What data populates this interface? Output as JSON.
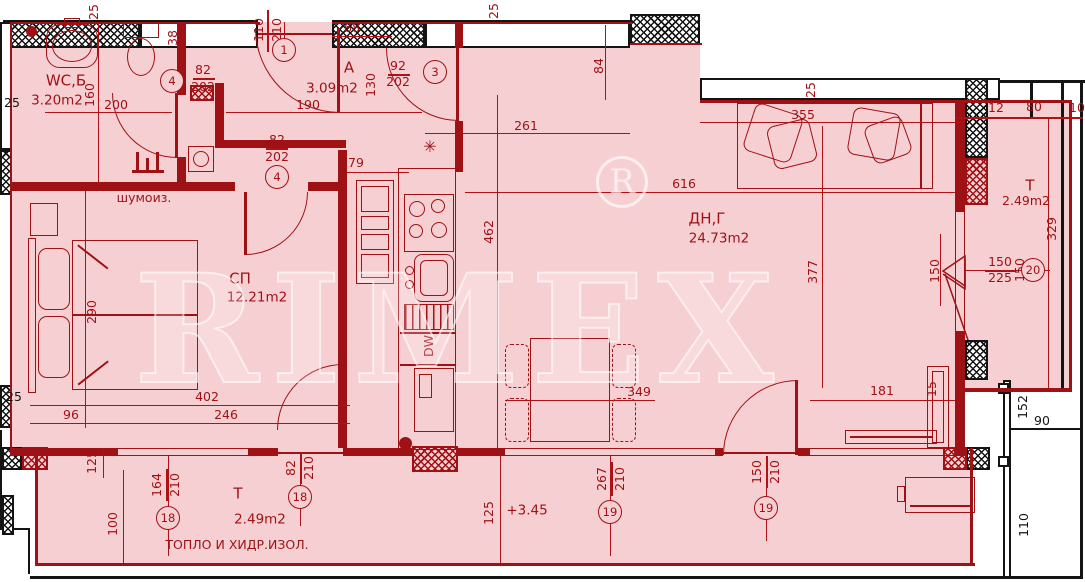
{
  "colors": {
    "pink": "#f6cfd2",
    "red": "#9e1115",
    "black": "#141414"
  },
  "rooms": {
    "wc": {
      "name": "WC,Б",
      "area": "3.20m2"
    },
    "hall": {
      "name": "А",
      "area": "3.09m2"
    },
    "bedroom": {
      "name": "СП",
      "area": "12.21m2"
    },
    "living": {
      "name": "ДН,Г",
      "area": "24.73m2"
    },
    "terrace": {
      "name": "Т",
      "area": "2.49m2"
    }
  },
  "notes": {
    "soundproof": "шумоиз.",
    "insulation": "ТОПЛО И ХИДР.ИЗОЛ.",
    "level": "+3.45",
    "dishwasher": "DW",
    "star": "✳"
  },
  "circles": {
    "c1": "1",
    "c3": "3",
    "c4": "4",
    "c18": "18",
    "c19": "19",
    "c20": "20"
  },
  "dims": {
    "v25": "25",
    "v110": "110",
    "v210": "210",
    "v68": "68",
    "v38": "38",
    "v82": "82",
    "v202": "202",
    "v160": "160",
    "v200": "200",
    "v190": "190",
    "v92": "92",
    "v130": "130",
    "v84": "84",
    "v261": "261",
    "v79": "79",
    "v355": "355",
    "v616": "616",
    "v377": "377",
    "v462": "462",
    "v290": "290",
    "v402": "402",
    "v96": "96",
    "v246": "246",
    "v349": "349",
    "v181": "181",
    "v15": "15",
    "v267": "267",
    "v150": "150",
    "v164": "164",
    "v100": "100",
    "v125": "125",
    "v329": "329",
    "v225": "225",
    "v12": "12",
    "v80": "80",
    "v10": "10",
    "v152": "152",
    "v90": "90",
    "v110b": "110"
  },
  "watermark": {
    "letter": "R",
    "text": "RIMEX"
  }
}
